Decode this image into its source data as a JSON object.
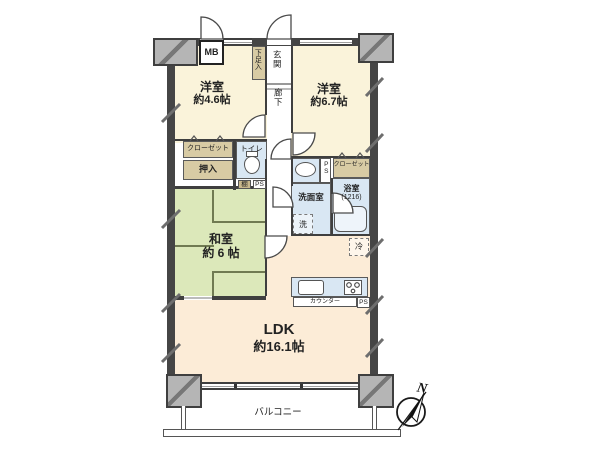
{
  "colors": {
    "room_cream": "#faf3da",
    "ldk_cream": "#fcecd7",
    "tatami_green": "#dce8ba",
    "water_blue": "#d9e7f3",
    "closet_tan": "#d8cba4",
    "shelf_tan": "#c9b88c",
    "pillar_gray": "#b5b5b5",
    "wall_dark": "#454545"
  },
  "rooms": {
    "western_left": {
      "name": "洋室",
      "area": "約4.6帖"
    },
    "western_right": {
      "name": "洋室",
      "area": "約6.7帖"
    },
    "japanese": {
      "name": "和室",
      "area": "約 6 帖"
    },
    "ldk": {
      "name": "LDK",
      "area": "約16.1帖"
    }
  },
  "spaces": {
    "balcony": "バルコニー",
    "entrance": "玄関",
    "corridor": "廊下",
    "shoe_cabinet": "下足入",
    "toilet": "トイレ",
    "closet_left": "クローゼット",
    "closet_right": "クローゼット",
    "oshiire": "押入",
    "shelf": "棚",
    "pipe_space": "PS",
    "washroom": "洗面室",
    "washer": "洗",
    "bathroom": "浴室",
    "bathroom_size": "(1216)",
    "fridge": "冷",
    "meter_box": "MB",
    "counter": "カウンター"
  },
  "compass": {
    "north": "N"
  }
}
